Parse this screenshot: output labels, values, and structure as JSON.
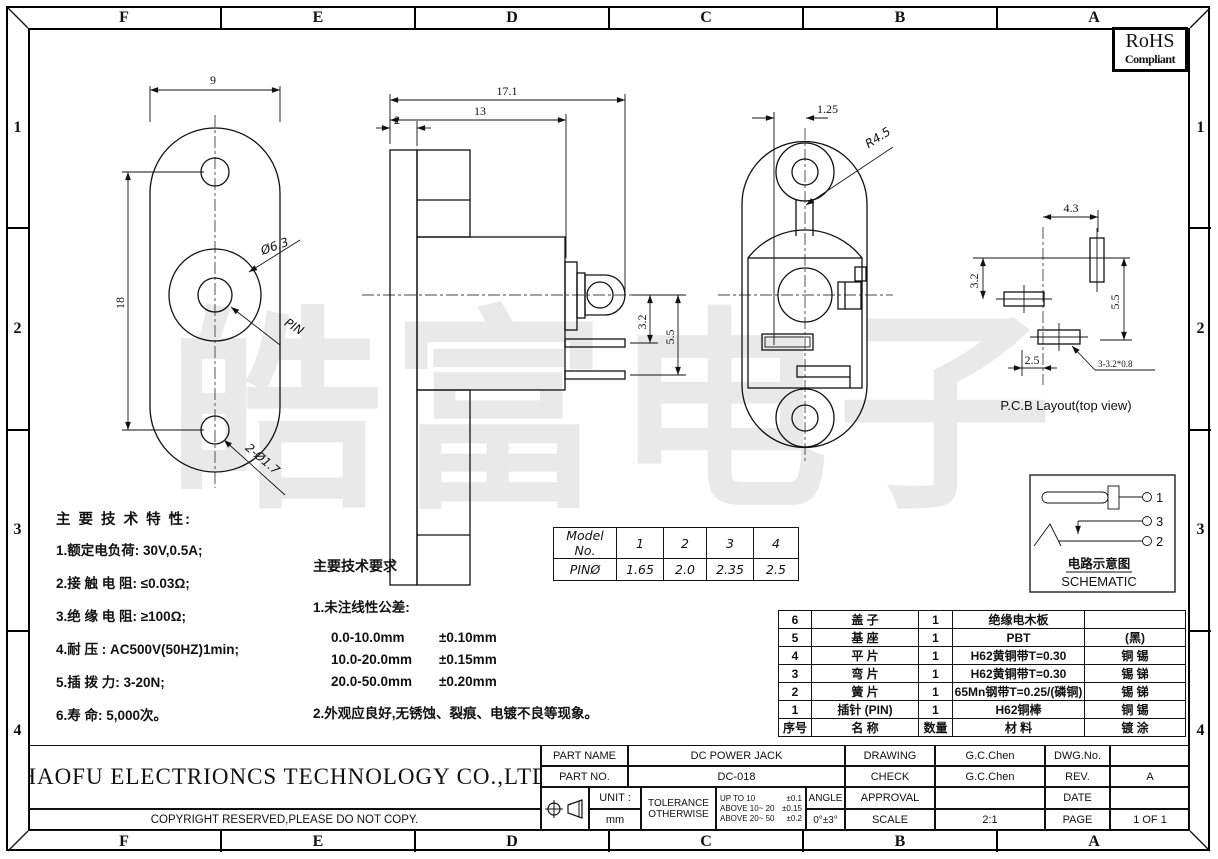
{
  "sheet": {
    "watermark": "皓富电子",
    "rohs": {
      "line1": "RoHS",
      "line2": "Compliant"
    },
    "grid_cols": [
      "F",
      "E",
      "D",
      "C",
      "B",
      "A"
    ],
    "grid_rows": [
      "1",
      "2",
      "3",
      "4"
    ]
  },
  "views": {
    "front": {
      "dim_width": "9",
      "dim_height": "18",
      "barrel_dia": "Ø6.3",
      "pin_label": "PIN",
      "mount_holes": "2-Ø1.7"
    },
    "side": {
      "dim_total": "17.1",
      "dim_body": "13",
      "dim_flange": "2",
      "dim_term1": "3.2",
      "dim_term2": "5.5"
    },
    "rear": {
      "dim_offset": "1.25",
      "dim_radius": "R4.5"
    },
    "pcb": {
      "dim_x": "4.3",
      "dim_y1": "3.2",
      "dim_y2": "5.5",
      "dim_x2": "2.5",
      "hole_note": "3-3.2*0.8",
      "caption": "P.C.B  Layout(top view)"
    },
    "schematic": {
      "pin1": "1",
      "pin3": "3",
      "pin2": "2",
      "title_cn": "电路示意图",
      "title_en": "SCHEMATIC"
    }
  },
  "model_table": {
    "header": [
      "Model No.",
      "1",
      "2",
      "3",
      "4"
    ],
    "row": [
      "PINØ",
      "1.65",
      "2.0",
      "2.35",
      "2.5"
    ]
  },
  "tech_spec": {
    "title": "主 要 技 术 特 性:",
    "items": [
      "1.额定电负荷: 30V,0.5A;",
      "2.接 触 电 阻: ≤0.03Ω;",
      "3.绝 缘 电 阻: ≥100Ω;",
      "4.耐      压 : AC500V(50HZ)1min;",
      "5.插 拨 力: 3-20N;",
      "6.寿      命: 5,000次。"
    ]
  },
  "tech_req": {
    "title": "主要技术要求",
    "item1": "1.未注线性公差:",
    "tolerances": [
      {
        "range": "0.0-10.0mm",
        "tol": "±0.10mm"
      },
      {
        "range": "10.0-20.0mm",
        "tol": "±0.15mm"
      },
      {
        "range": "20.0-50.0mm",
        "tol": "±0.20mm"
      }
    ],
    "item2": "2.外观应良好,无锈蚀、裂痕、电镀不良等现象。"
  },
  "bom": {
    "header": {
      "no": "序号",
      "name": "名  称",
      "qty": "数量",
      "material": "材  料",
      "plating": "镀  涂"
    },
    "rows": [
      {
        "no": "6",
        "name": "盖  子",
        "qty": "1",
        "material": "绝缘电木板",
        "plating": ""
      },
      {
        "no": "5",
        "name": "基  座",
        "qty": "1",
        "material": "PBT",
        "plating": "(黑)"
      },
      {
        "no": "4",
        "name": "平  片",
        "qty": "1",
        "material": "H62黄铜带T=0.30",
        "plating": "铜 锡"
      },
      {
        "no": "3",
        "name": "弯  片",
        "qty": "1",
        "material": "H62黄铜带T=0.30",
        "plating": "锡 锑"
      },
      {
        "no": "2",
        "name": "簧  片",
        "qty": "1",
        "material": "65Mn钢带T=0.25/(磷铜)",
        "plating": "锡 锑"
      },
      {
        "no": "1",
        "name": "插针 (PIN)",
        "qty": "1",
        "material": "H62铜棒",
        "plating": "铜 锡"
      }
    ]
  },
  "title_block": {
    "company": "HAOFU ELECTRIONCS TECHNOLOGY CO.,LTD",
    "copyright": "COPYRIGHT RESERVED,PLEASE DO NOT COPY.",
    "part_name_label": "PART NAME",
    "part_name": "DC POWER JACK",
    "part_no_label": "PART NO.",
    "part_no": "DC-018",
    "drawing_label": "DRAWING",
    "drawing_by": "G.C.Chen",
    "check_label": "CHECK",
    "check_by": "G.C.Chen",
    "approval_label": "APPROVAL",
    "approval_by": "",
    "scale_label": "SCALE",
    "scale": "2:1",
    "dwg_no_label": "DWG.No.",
    "dwg_no": "",
    "rev_label": "REV.",
    "rev": "A",
    "date_label": "DATE",
    "date": "",
    "page_label": "PAGE",
    "page": "1 OF 1",
    "unit_label": "UNIT :",
    "unit": "mm",
    "tolerance_label1": "TOLERANCE",
    "tolerance_label2": "OTHERWISE",
    "tol_rows": [
      {
        "range": "UP TO 10",
        "val": "±0.1"
      },
      {
        "range": "ABOVE 10~ 20",
        "val": "±0.15"
      },
      {
        "range": "ABOVE 20~ 50",
        "val": "±0.2"
      }
    ],
    "angle_label": "ANGLE",
    "angle_val": "0°±3°"
  }
}
